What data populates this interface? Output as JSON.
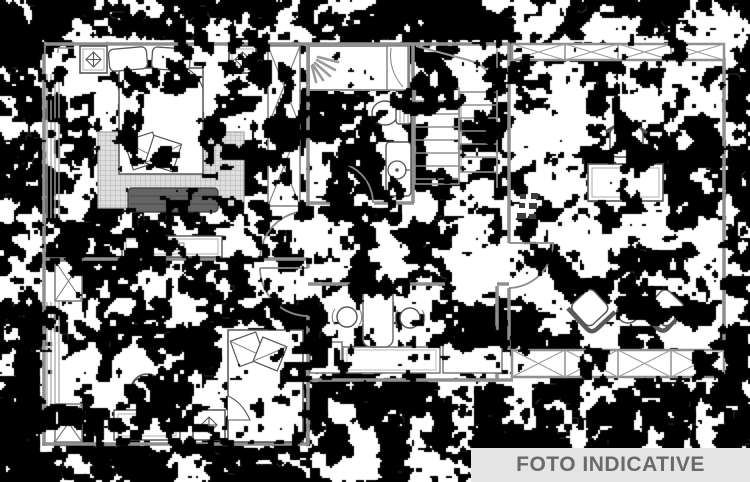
{
  "banner": {
    "label": "FOTO INDICATIVE",
    "background": "#e4e4e4",
    "text_color": "#6a6a6a"
  },
  "plan": {
    "kind": "apartment-floor-plan",
    "render_style": "dithered-black-white-scan",
    "colors": {
      "paper": "#ffffff",
      "ink": "#000000",
      "wall": "#8f8f8f",
      "furniture_line": "#4d4d4d"
    },
    "elements": [
      "double-bed",
      "pillows",
      "rug",
      "bench",
      "nightstand-spotlight",
      "wardrobe-x",
      "dresser",
      "staircase",
      "shower",
      "shower-spray",
      "toilet",
      "washbasin",
      "twin-washbasins",
      "vanity-counter",
      "single-bed",
      "desk",
      "desk-chair",
      "office-desk",
      "office-chair",
      "armchair",
      "round-side-table",
      "window-band-x",
      "door-swing",
      "radiator"
    ]
  }
}
